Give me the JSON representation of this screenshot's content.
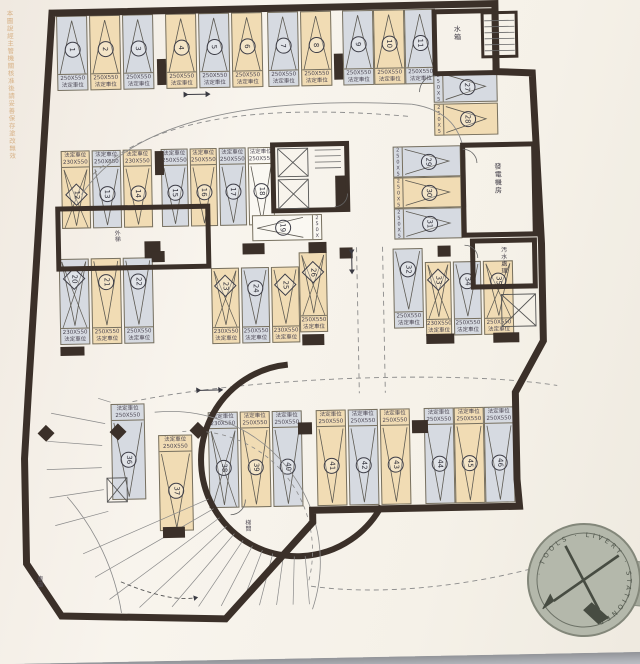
{
  "document": {
    "watermark": "本圖說經主管機關核准後請妥善保存塗改無效",
    "stall_type": "法定車位"
  },
  "plan": {
    "rooms": {
      "water_tank": "水箱",
      "generator": "發電機房",
      "sewage": "汚水處理",
      "outer_stair": "外梯",
      "stair_hall": "梯間",
      "ramp": "車道"
    },
    "stalls": [
      {
        "no": "1",
        "size": "250X550",
        "color": "gray",
        "shape": "circle",
        "cross": false,
        "x": 66,
        "y": 13,
        "w": 31,
        "h": 75,
        "o": "v",
        "apex": "up",
        "ls": "bottom",
        "p": 0.58
      },
      {
        "no": "2",
        "size": "250X550",
        "color": "tan",
        "shape": "circle",
        "cross": false,
        "x": 99,
        "y": 13,
        "w": 31,
        "h": 75,
        "o": "v",
        "apex": "up",
        "ls": "bottom",
        "p": 0.58
      },
      {
        "no": "3",
        "size": "250X550",
        "color": "gray",
        "shape": "circle",
        "cross": false,
        "x": 132,
        "y": 13,
        "w": 31,
        "h": 75,
        "o": "v",
        "apex": "up",
        "ls": "bottom",
        "p": 0.58
      },
      {
        "no": "4",
        "size": "250X550",
        "color": "tan",
        "shape": "circle",
        "cross": false,
        "x": 175,
        "y": 13,
        "w": 31,
        "h": 75,
        "o": "v",
        "apex": "up",
        "ls": "bottom",
        "p": 0.58
      },
      {
        "no": "5",
        "size": "250X550",
        "color": "gray",
        "shape": "circle",
        "cross": false,
        "x": 208,
        "y": 13,
        "w": 31,
        "h": 75,
        "o": "v",
        "apex": "up",
        "ls": "bottom",
        "p": 0.58
      },
      {
        "no": "6",
        "size": "250X550",
        "color": "tan",
        "shape": "circle",
        "cross": false,
        "x": 241,
        "y": 13,
        "w": 31,
        "h": 75,
        "o": "v",
        "apex": "up",
        "ls": "bottom",
        "p": 0.58
      },
      {
        "no": "7",
        "size": "250X550",
        "color": "gray",
        "shape": "circle",
        "cross": false,
        "x": 277,
        "y": 13,
        "w": 31,
        "h": 75,
        "o": "v",
        "apex": "up",
        "ls": "bottom",
        "p": 0.58
      },
      {
        "no": "8",
        "size": "250X550",
        "color": "tan",
        "shape": "circle",
        "cross": false,
        "x": 310,
        "y": 13,
        "w": 31,
        "h": 75,
        "o": "v",
        "apex": "up",
        "ls": "bottom",
        "p": 0.58
      },
      {
        "no": "9",
        "size": "250X550",
        "color": "gray",
        "shape": "circle",
        "cross": false,
        "x": 352,
        "y": 13,
        "w": 31,
        "h": 75,
        "o": "v",
        "apex": "up",
        "ls": "bottom",
        "p": 0.58
      },
      {
        "no": "10",
        "size": "250X550",
        "color": "tan",
        "shape": "circle",
        "cross": false,
        "x": 383,
        "y": 13,
        "w": 31,
        "h": 75,
        "o": "v",
        "apex": "up",
        "ls": "bottom",
        "p": 0.58
      },
      {
        "no": "11",
        "size": "250X550",
        "color": "gray",
        "shape": "circle",
        "cross": false,
        "x": 414,
        "y": 13,
        "w": 31,
        "h": 75,
        "o": "v",
        "apex": "up",
        "ls": "bottom",
        "p": 0.58
      },
      {
        "no": "12",
        "size": "230X550",
        "color": "tan",
        "shape": "diamond",
        "cross": true,
        "x": 68,
        "y": 148,
        "w": 29,
        "h": 78,
        "o": "v",
        "apex": "down",
        "ls": "top",
        "p": 0.45
      },
      {
        "no": "13",
        "size": "250X550",
        "color": "gray",
        "shape": "circle",
        "cross": false,
        "x": 99,
        "y": 148,
        "w": 29,
        "h": 78,
        "o": "v",
        "apex": "down",
        "ls": "top",
        "p": 0.45
      },
      {
        "no": "14",
        "size": "230X550",
        "color": "tan",
        "shape": "circle",
        "cross": false,
        "x": 130,
        "y": 148,
        "w": 29,
        "h": 78,
        "o": "v",
        "apex": "down",
        "ls": "top",
        "p": 0.45
      },
      {
        "no": "15",
        "size": "250X550",
        "color": "gray",
        "shape": "circle",
        "cross": false,
        "x": 168,
        "y": 148,
        "w": 27,
        "h": 78,
        "o": "v",
        "apex": "down",
        "ls": "top",
        "p": 0.45
      },
      {
        "no": "16",
        "size": "250X550",
        "color": "tan",
        "shape": "circle",
        "cross": false,
        "x": 197,
        "y": 148,
        "w": 27,
        "h": 78,
        "o": "v",
        "apex": "down",
        "ls": "top",
        "p": 0.45
      },
      {
        "no": "17",
        "size": "250X550",
        "color": "gray",
        "shape": "circle",
        "cross": false,
        "x": 226,
        "y": 148,
        "w": 27,
        "h": 78,
        "o": "v",
        "apex": "down",
        "ls": "top",
        "p": 0.45
      },
      {
        "no": "18",
        "size": "250X550",
        "color": "white",
        "shape": "circle",
        "cross": false,
        "x": 255,
        "y": 148,
        "w": 26,
        "h": 78,
        "o": "v",
        "apex": "down",
        "ls": "top",
        "p": 0.45
      },
      {
        "no": "19",
        "size": "250X550",
        "color": "white",
        "shape": "circle",
        "cross": false,
        "x": 258,
        "y": 216,
        "w": 70,
        "h": 26,
        "o": "h",
        "apex": "left",
        "ls": "right",
        "p": 0.5
      },
      {
        "no": "20",
        "size": "230X550",
        "color": "gray",
        "shape": "diamond",
        "cross": true,
        "x": 64,
        "y": 256,
        "w": 30,
        "h": 86,
        "o": "v",
        "apex": "down",
        "ls": "bottom",
        "p": 0.28
      },
      {
        "no": "21",
        "size": "250X550",
        "color": "tan",
        "shape": "circle",
        "cross": false,
        "x": 96,
        "y": 256,
        "w": 30,
        "h": 86,
        "o": "v",
        "apex": "down",
        "ls": "bottom",
        "p": 0.34
      },
      {
        "no": "22",
        "size": "250X550",
        "color": "gray",
        "shape": "circle",
        "cross": false,
        "x": 128,
        "y": 256,
        "w": 30,
        "h": 86,
        "o": "v",
        "apex": "down",
        "ls": "bottom",
        "p": 0.34
      },
      {
        "no": "23",
        "size": "230X550",
        "color": "tan",
        "shape": "diamond",
        "cross": true,
        "x": 216,
        "y": 268,
        "w": 28,
        "h": 76,
        "o": "v",
        "apex": "down",
        "ls": "bottom",
        "p": 0.3
      },
      {
        "no": "24",
        "size": "250X550",
        "color": "gray",
        "shape": "circle",
        "cross": false,
        "x": 246,
        "y": 268,
        "w": 28,
        "h": 76,
        "o": "v",
        "apex": "down",
        "ls": "bottom",
        "p": 0.34
      },
      {
        "no": "25",
        "size": "230X550",
        "color": "tan",
        "shape": "diamond",
        "cross": false,
        "x": 276,
        "y": 268,
        "w": 28,
        "h": 76,
        "o": "v",
        "apex": "down",
        "ls": "bottom",
        "p": 0.3
      },
      {
        "no": "26",
        "size": "250X550",
        "color": "tan",
        "shape": "diamond",
        "cross": true,
        "x": 304,
        "y": 254,
        "w": 28,
        "h": 80,
        "o": "v",
        "apex": "down",
        "ls": "bottom",
        "p": 0.3
      },
      {
        "no": "27",
        "size": "250X550",
        "color": "gray",
        "shape": "circle",
        "cross": false,
        "x": 442,
        "y": 76,
        "w": 64,
        "h": 31,
        "o": "h",
        "apex": "right",
        "ls": "left",
        "p": 0.45
      },
      {
        "no": "28",
        "size": "250X550",
        "color": "tan",
        "shape": "circle",
        "cross": false,
        "x": 442,
        "y": 108,
        "w": 64,
        "h": 32,
        "o": "h",
        "apex": "right",
        "ls": "left",
        "p": 0.45
      },
      {
        "no": "29",
        "size": "250X550",
        "color": "gray",
        "shape": "circle",
        "cross": false,
        "x": 400,
        "y": 150,
        "w": 68,
        "h": 31,
        "o": "h",
        "apex": "right",
        "ls": "left",
        "p": 0.45
      },
      {
        "no": "30",
        "size": "250X550",
        "color": "tan",
        "shape": "circle",
        "cross": false,
        "x": 400,
        "y": 181,
        "w": 68,
        "h": 31,
        "o": "h",
        "apex": "right",
        "ls": "left",
        "p": 0.45
      },
      {
        "no": "31",
        "size": "250X550",
        "color": "gray",
        "shape": "circle",
        "cross": false,
        "x": 400,
        "y": 212,
        "w": 68,
        "h": 31,
        "o": "h",
        "apex": "right",
        "ls": "left",
        "p": 0.45
      },
      {
        "no": "32",
        "size": "250X550",
        "color": "gray",
        "shape": "circle",
        "cross": false,
        "x": 398,
        "y": 252,
        "w": 30,
        "h": 80,
        "o": "v",
        "apex": "down",
        "ls": "bottom",
        "p": 0.32
      },
      {
        "no": "33",
        "size": "230X550",
        "color": "tan",
        "shape": "diamond",
        "cross": true,
        "x": 430,
        "y": 266,
        "w": 26,
        "h": 74,
        "o": "v",
        "apex": "down",
        "ls": "bottom",
        "p": 0.3
      },
      {
        "no": "34",
        "size": "250X550",
        "color": "gray",
        "shape": "circle",
        "cross": false,
        "x": 458,
        "y": 266,
        "w": 28,
        "h": 74,
        "o": "v",
        "apex": "down",
        "ls": "bottom",
        "p": 0.34
      },
      {
        "no": "35",
        "size": "250X550",
        "color": "tan",
        "shape": "circle",
        "cross": true,
        "x": 488,
        "y": 266,
        "w": 30,
        "h": 74,
        "o": "v",
        "apex": "down",
        "ls": "bottom",
        "p": 0.34
      },
      {
        "no": "36",
        "size": "250X550",
        "color": "gray",
        "shape": "circle",
        "cross": false,
        "x": 113,
        "y": 402,
        "w": 34,
        "h": 96,
        "o": "v",
        "apex": "down",
        "ls": "top",
        "p": 0.5
      },
      {
        "no": "37",
        "size": "250X550",
        "color": "tan",
        "shape": "circle",
        "cross": false,
        "x": 160,
        "y": 434,
        "w": 34,
        "h": 96,
        "o": "v",
        "apex": "down",
        "ls": "top",
        "p": 0.5
      },
      {
        "no": "38",
        "size": "230X550",
        "color": "gray",
        "shape": "circle",
        "cross": true,
        "x": 210,
        "y": 412,
        "w": 30,
        "h": 96,
        "o": "v",
        "apex": "down",
        "ls": "top",
        "p": 0.5
      },
      {
        "no": "39",
        "size": "250X550",
        "color": "tan",
        "shape": "circle",
        "cross": false,
        "x": 242,
        "y": 412,
        "w": 30,
        "h": 96,
        "o": "v",
        "apex": "down",
        "ls": "top",
        "p": 0.5
      },
      {
        "no": "40",
        "size": "250X550",
        "color": "gray",
        "shape": "circle",
        "cross": false,
        "x": 274,
        "y": 412,
        "w": 30,
        "h": 96,
        "o": "v",
        "apex": "down",
        "ls": "top",
        "p": 0.5
      },
      {
        "no": "41",
        "size": "250X550",
        "color": "tan",
        "shape": "circle",
        "cross": false,
        "x": 318,
        "y": 412,
        "w": 30,
        "h": 96,
        "o": "v",
        "apex": "down",
        "ls": "top",
        "p": 0.5
      },
      {
        "no": "42",
        "size": "250X550",
        "color": "gray",
        "shape": "circle",
        "cross": false,
        "x": 350,
        "y": 412,
        "w": 30,
        "h": 96,
        "o": "v",
        "apex": "down",
        "ls": "top",
        "p": 0.5
      },
      {
        "no": "43",
        "size": "250X550",
        "color": "tan",
        "shape": "circle",
        "cross": false,
        "x": 382,
        "y": 412,
        "w": 30,
        "h": 96,
        "o": "v",
        "apex": "down",
        "ls": "top",
        "p": 0.5
      },
      {
        "no": "44",
        "size": "250X550",
        "color": "gray",
        "shape": "circle",
        "cross": false,
        "x": 426,
        "y": 412,
        "w": 30,
        "h": 96,
        "o": "v",
        "apex": "down",
        "ls": "top",
        "p": 0.5
      },
      {
        "no": "45",
        "size": "250X550",
        "color": "tan",
        "shape": "circle",
        "cross": false,
        "x": 456,
        "y": 412,
        "w": 30,
        "h": 96,
        "o": "v",
        "apex": "down",
        "ls": "top",
        "p": 0.5
      },
      {
        "no": "46",
        "size": "250X550",
        "color": "gray",
        "shape": "circle",
        "cross": false,
        "x": 486,
        "y": 412,
        "w": 30,
        "h": 96,
        "o": "v",
        "apex": "down",
        "ls": "top",
        "p": 0.5
      }
    ]
  },
  "medallion": {
    "ring_text": "· TOOLS · LIVERY · STATIONER"
  },
  "colors": {
    "tan": "#f1dcb4",
    "gray": "#d6dae1",
    "white": "#faf8f2",
    "wall": "#3b3029",
    "paper": "#f6f2ea"
  }
}
